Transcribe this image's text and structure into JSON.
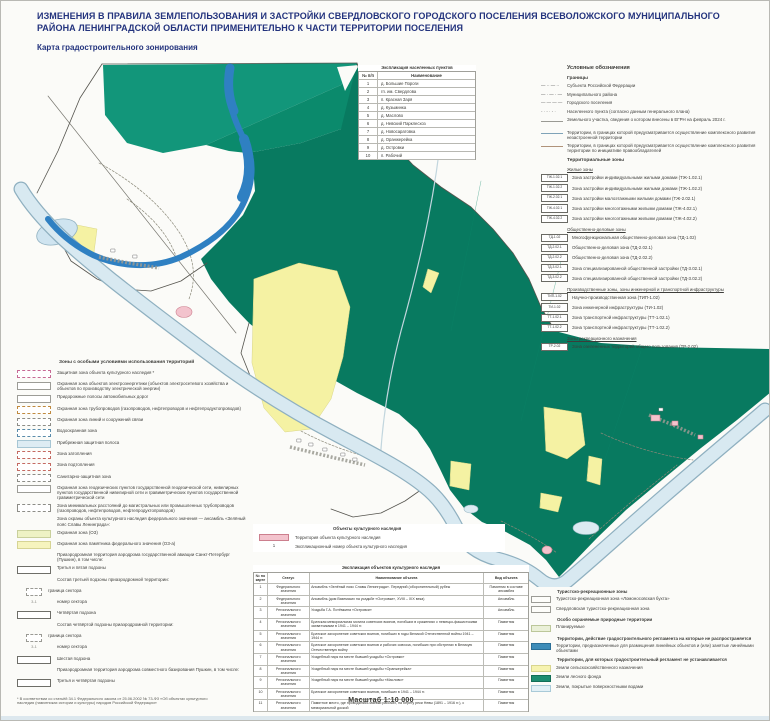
{
  "title": {
    "line1": "ИЗМЕНЕНИЯ В ПРАВИЛА ЗЕМЛЕПОЛЬЗОВАНИЯ И ЗАСТРОЙКИ СВЕРДЛОВСКОГО ГОРОДСКОГО ПОСЕЛЕНИЯ ВСЕВОЛОЖСКОГО МУНИЦИПАЛЬНОГО РАЙОНА ЛЕНИНГРАДСКОЙ ОБЛАСТИ ПРИМЕНИТЕЛЬНО К ЧАСТИ ТЕРРИТОРИИ ПОСЕЛЕНИЯ",
    "subtitle": "Карта градостроительного зонирования"
  },
  "settlements_table": {
    "caption": "Экспликация населенных пунктов",
    "col_n": "№ п/п",
    "col_name": "Наименование",
    "rows": [
      {
        "n": "1",
        "name": "д. Большие Пороги"
      },
      {
        "n": "2",
        "name": "гп. им. Свердлова"
      },
      {
        "n": "3",
        "name": "п. Красная Заря"
      },
      {
        "n": "4",
        "name": "д. Кузьминка"
      },
      {
        "n": "5",
        "name": "д. Маслово"
      },
      {
        "n": "6",
        "name": "д. Невский Парклесхоз"
      },
      {
        "n": "7",
        "name": "д. Новосаратовка"
      },
      {
        "n": "8",
        "name": "д. Оранжерейка"
      },
      {
        "n": "9",
        "name": "д. Островки"
      },
      {
        "n": "10",
        "name": "п. Рабочий"
      }
    ]
  },
  "legend_right": {
    "header": "Условные обозначения",
    "borders_title": "Границы",
    "borders": [
      {
        "sw": "l1",
        "label": "Субъекта Российской Федерации"
      },
      {
        "sw": "l2",
        "label": "Муниципального района"
      },
      {
        "sw": "l3",
        "label": "Городского поселения"
      },
      {
        "sw": "l4",
        "label": "Населенного пункта (согласно данным генерального плана)"
      },
      {
        "sw": "l5",
        "label": "Земельного участка, сведения о котором внесены в ЕГРН на февраль 2024 г."
      },
      {
        "sw": "l6",
        "label": "Территории, в границах которой предусматривается осуществление комплексного развития незастроенной территории"
      },
      {
        "sw": "l7",
        "label": "Территории, в границах которой предусматривается осуществление комплексного развития территории по инициативе правообладателей"
      }
    ],
    "zones_header": "Территориальные зоны",
    "group1_title": "Жилые зоны",
    "group1": [
      {
        "code": "ТЖ-1.02.1",
        "label": "Зона застройки индивидуальными жилыми домами (ТЖ-1.02.1)"
      },
      {
        "code": "ТЖ-1.02.2",
        "label": "Зона застройки индивидуальными жилыми домами (ТЖ-1.02.2)"
      },
      {
        "code": "ТЖ-2.02.1",
        "label": "Зона застройки малоэтажными жилыми домами (ТЖ-2.02.1)"
      },
      {
        "code": "ТЖ-4.02.1",
        "label": "Зона застройки многоэтажными жилыми домами (ТЖ-4.02.1)"
      },
      {
        "code": "ТЖ-4.02.2",
        "label": "Зона застройки многоэтажными жилыми домами (ТЖ-4.02.2)"
      }
    ],
    "group2_title": "Общественно-деловые зоны",
    "group2": [
      {
        "code": "ТД-1.02",
        "label": "Многофункциональная общественно-деловая зона (ТД-1.02)"
      },
      {
        "code": "ТД-2.02.1",
        "label": "Общественно-деловая зона (ТД-2.02.1)"
      },
      {
        "code": "ТД-2.02.2",
        "label": "Общественно-деловая зона (ТД-2.02.2)"
      },
      {
        "code": "ТД-3.02.1",
        "label": "Зона специализированной общественной застройки (ТД-3.02.1)"
      },
      {
        "code": "ТД-3.02.2",
        "label": "Зона специализированной общественной застройки (ТД-3.02.2)"
      }
    ],
    "group3_title": "Производственные зоны, зоны инженерной и транспортной инфраструктуры",
    "group3": [
      {
        "code": "ТИП-1.02",
        "label": "Научно-производственная зона (ТИП-1.02)"
      },
      {
        "code": "ТИ-1.02",
        "label": "Зона инженерной инфраструктуры (ТИ-1.02)"
      },
      {
        "code": "ТТ-1.02.1",
        "label": "Зона транспортной инфраструктуры (ТТ-1.02.1)"
      },
      {
        "code": "ТТ-1.02.2",
        "label": "Зона транспортной инфраструктуры (ТТ-1.02.2)"
      }
    ],
    "group4_title": "Зоны рекреационного назначения",
    "group4": [
      {
        "code": "ТР-2.02",
        "label": "Зона озелененных территорий общего пользования (ТР-2.02)"
      }
    ]
  },
  "legend_left": {
    "header": "Зоны с особыми условиями использования территорий",
    "items": [
      {
        "sw": "dashpink",
        "label": "Защитная зона объекта культурного наследия *"
      },
      {
        "sw": "solidgray",
        "label": "Охранная зона объектов электроэнергетики (объектов электросетевого хозяйства и объектов по производству электрической энергии)"
      },
      {
        "sw": "solidgray",
        "label": "Придорожные полосы автомобильных дорог"
      },
      {
        "sw": "dashorange",
        "label": "Охранная зона трубопроводов (газопроводов, нефтепроводов и нефтепродуктопроводов)"
      },
      {
        "sw": "dashgray",
        "label": "Охранная зона линий и сооружений связи"
      },
      {
        "sw": "dashblue",
        "label": "Водоохранная зона"
      },
      {
        "sw": "tintblue",
        "label": "Прибрежная защитная полоса"
      },
      {
        "sw": "dashred",
        "label": "Зона затопления"
      },
      {
        "sw": "dashred",
        "label": "Зона подтопления"
      },
      {
        "sw": "dashgray",
        "label": "Санитарно-защитная зона"
      },
      {
        "sw": "solidgray",
        "label": "Охранная зона геодезических пунктов государственной геодезической сети, нивелирных пунктов государственной нивелирной сети и гравиметрических пунктов государственной гравиметрической сети"
      },
      {
        "sw": "bracket",
        "label": "Зона минимальных расстояний до магистральных или промышленных трубопроводов (газопроводов, нефтепроводов, нефтепродуктопроводов)"
      },
      {
        "sw": "none",
        "label": "Зона охраны объекта культурного наследия федерального значения — ансамбль «Зелёный пояс Славы Ленинграда»:"
      },
      {
        "sw": "tintyg",
        "label": "Охранная зона (ОЗ)"
      },
      {
        "sw": "tinty",
        "label": "Охранная зона памятника федерального значения (ОЗ-а)"
      },
      {
        "sw": "none",
        "label": "Приаэродромная территория аэродрома государственной авиации Санкт-Петербург (Пушкин), в том числе:"
      },
      {
        "sw": "box",
        "label": "Третья и пятая подзоны"
      },
      {
        "sw": "none",
        "label": "Состав третьей подзоны приаэродромной территории:"
      },
      {
        "sw": "dashsmall",
        "label": "граница сектора"
      },
      {
        "sw": "numtext",
        "label": "номер сектора"
      },
      {
        "sw": "box",
        "label": "Четвёртая подзона"
      },
      {
        "sw": "none",
        "label": "Состав четвёртой подзоны приаэродромной территории:"
      },
      {
        "sw": "dashsmall",
        "label": "граница сектора"
      },
      {
        "sw": "numtext",
        "label": "номер сектора"
      },
      {
        "sw": "box",
        "label": "Шестая подзона"
      },
      {
        "sw": "none",
        "label": "Приаэродромная территория аэродрома совместного базирования Пушкин, в том числе:"
      },
      {
        "sw": "box",
        "label": "Третья и четвёртая подзоны"
      }
    ],
    "footnote": "* В соответствии со статьёй 34.1 Федерального закона от 25.06.2002 № 73-ФЗ «Об объектах культурного наследия (памятниках истории и культуры) народов Российской Федерации»"
  },
  "heritage_legend": {
    "title": "Объекты культурного наследия",
    "items": [
      {
        "sw": "pink",
        "label": "Территория объекта культурного наследия"
      },
      {
        "sw": "num",
        "label": "Экспликационный номер объекта культурного наследия"
      }
    ]
  },
  "heritage_table": {
    "caption": "Экспликация объектов культурного наследия",
    "col_n": "№ по карте",
    "col_status": "Статус",
    "col_name": "Наименование объекта",
    "col_kind": "Вид объекта",
    "rows": [
      {
        "n": "1",
        "status": "Федерального значения",
        "name": "Ансамбль «Зелёный пояс Славы Ленинграда». Передний (оборонительный) рубеж",
        "kind": "Памятник в составе ансамбля"
      },
      {
        "n": "2",
        "status": "Федерального значения",
        "name": "Ансамбль (дом Вяземских на усадьбе «Островки», XVIII – XIX века)",
        "kind": "Ансамбль"
      },
      {
        "n": "3",
        "status": "Регионального значения",
        "name": "Усадьба Г.А. Потёмкина «Островки»",
        "kind": "Ансамбль"
      },
      {
        "n": "4",
        "status": "Регионального значения",
        "name": "Братская мемориальная могила советских воинов, погибших в сражениях с немецко-фашистскими захватчиками в 1941 – 1944 гг.",
        "kind": "Памятник"
      },
      {
        "n": "5",
        "status": "Регионального значения",
        "name": "Братское захоронение советских воинов, погибших в годы Великой Отечественной войны 1941 – 1944 гг.",
        "kind": "Памятник"
      },
      {
        "n": "6",
        "status": "Регионального значения",
        "name": "Братское захоронение советских воинов и рабочих совхоза, погибших при обстрелах в Великую Отечественную войну",
        "kind": "Памятник"
      },
      {
        "n": "7",
        "status": "Регионального значения",
        "name": "Усадебный парк на месте бывшей усадьбы «Островки»",
        "kind": "Памятник"
      },
      {
        "n": "8",
        "status": "Регионального значения",
        "name": "Усадебный парк на месте бывшей усадьбы «Оранжерейка»",
        "kind": "Памятник"
      },
      {
        "n": "9",
        "status": "Регионального значения",
        "name": "Усадебный парк на месте бывшей усадьбы «Маслово»",
        "kind": "Памятник"
      },
      {
        "n": "10",
        "status": "Регионального значения",
        "name": "Братское захоронение советских воинов, погибших в 1941 – 1944 гг.",
        "kind": "Памятник"
      },
      {
        "n": "11",
        "status": "Регионального значения",
        "name": "Памятное место, где проводились маёвки рабочих, на берегу реки Невы (1891 – 1916 гг.), с мемориальной доской",
        "kind": "Памятник"
      }
    ]
  },
  "legend_bottom_right": {
    "sections": [
      {
        "title": "Туристско-рекреационные зоны",
        "items": [
          {
            "sw": "outline",
            "label": "Туристско-рекреационная зона «Ломоносовская бухта»"
          },
          {
            "sw": "outline",
            "label": "Свердловская туристско-рекреационная зона"
          }
        ]
      },
      {
        "title": "Особо охраняемые природные территории",
        "items": [
          {
            "sw": "tgreen",
            "label": "Планируемые"
          }
        ]
      },
      {
        "title": "Территории, действие градостроительного регламента на которые не распространяется",
        "items": [
          {
            "sw": "blue",
            "label": "Территории, предназначенные для размещения линейных объектов и (или) занятые линейными объектами"
          }
        ]
      },
      {
        "title": "Территории, для которых градостроительный регламент не устанавливается",
        "items": [
          {
            "sw": "pyellow",
            "label": "Земли сельскохозяйственного назначения"
          },
          {
            "sw": "green",
            "label": "Земли лесного фонда"
          },
          {
            "sw": "pblue",
            "label": "Земли, покрытые поверхностными водами"
          }
        ]
      }
    ]
  },
  "scale_label": "Масштаб 1:10 000",
  "colors": {
    "title_navy": "#23337d",
    "forest_dark": "#087a60",
    "forest_mid": "#0b8a6c",
    "forest_light": "#12967a",
    "farmland_yellow": "#f5f2a3",
    "river_blue": "#2f80c2",
    "neva_fill": "#d8e9f1",
    "heritage_pink": "#f3c3cd"
  }
}
